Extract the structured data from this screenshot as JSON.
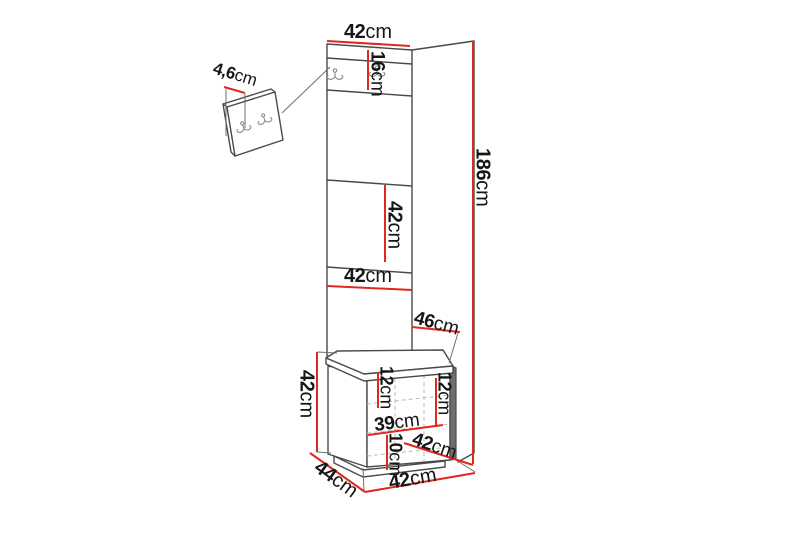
{
  "figure": {
    "title": "Hallway furniture set dimension diagram",
    "subject": "tall panel with coat hooks, wall hook panel and upholstered storage bench",
    "unit_system": "cm",
    "colors": {
      "dimension_line": "#e02720",
      "structure_line": "#4a4a4a",
      "stitch_line": "#bcbcbc",
      "label_text": "#161616",
      "background": "#ffffff"
    }
  },
  "icons": {
    "coat_hook": "double-coat-hook-icon"
  },
  "measurements": {
    "panel_top_width": {
      "value": "42",
      "unit": "cm"
    },
    "hook_section_height": {
      "value": "16",
      "unit": "cm"
    },
    "wall_hook_width": {
      "value": "4,6",
      "unit": "cm"
    },
    "panel_segment_height": {
      "value": "42",
      "unit": "cm"
    },
    "panel_lower_width": {
      "value": "42",
      "unit": "cm"
    },
    "top_depth": {
      "value": "46",
      "unit": "cm"
    },
    "total_height": {
      "value": "186",
      "unit": "cm"
    },
    "bench_height": {
      "value": "42",
      "unit": "cm"
    },
    "seat_cushion_height_left": {
      "value": "12",
      "unit": "cm"
    },
    "seat_cushion_height_right": {
      "value": "12",
      "unit": "cm"
    },
    "bench_inner_width": {
      "value": "39",
      "unit": "cm"
    },
    "plinth_height": {
      "value": "10",
      "unit": "cm"
    },
    "seat_depth": {
      "value": "42",
      "unit": "cm"
    },
    "bench_depth": {
      "value": "44",
      "unit": "cm"
    },
    "bench_width": {
      "value": "42",
      "unit": "cm"
    }
  }
}
